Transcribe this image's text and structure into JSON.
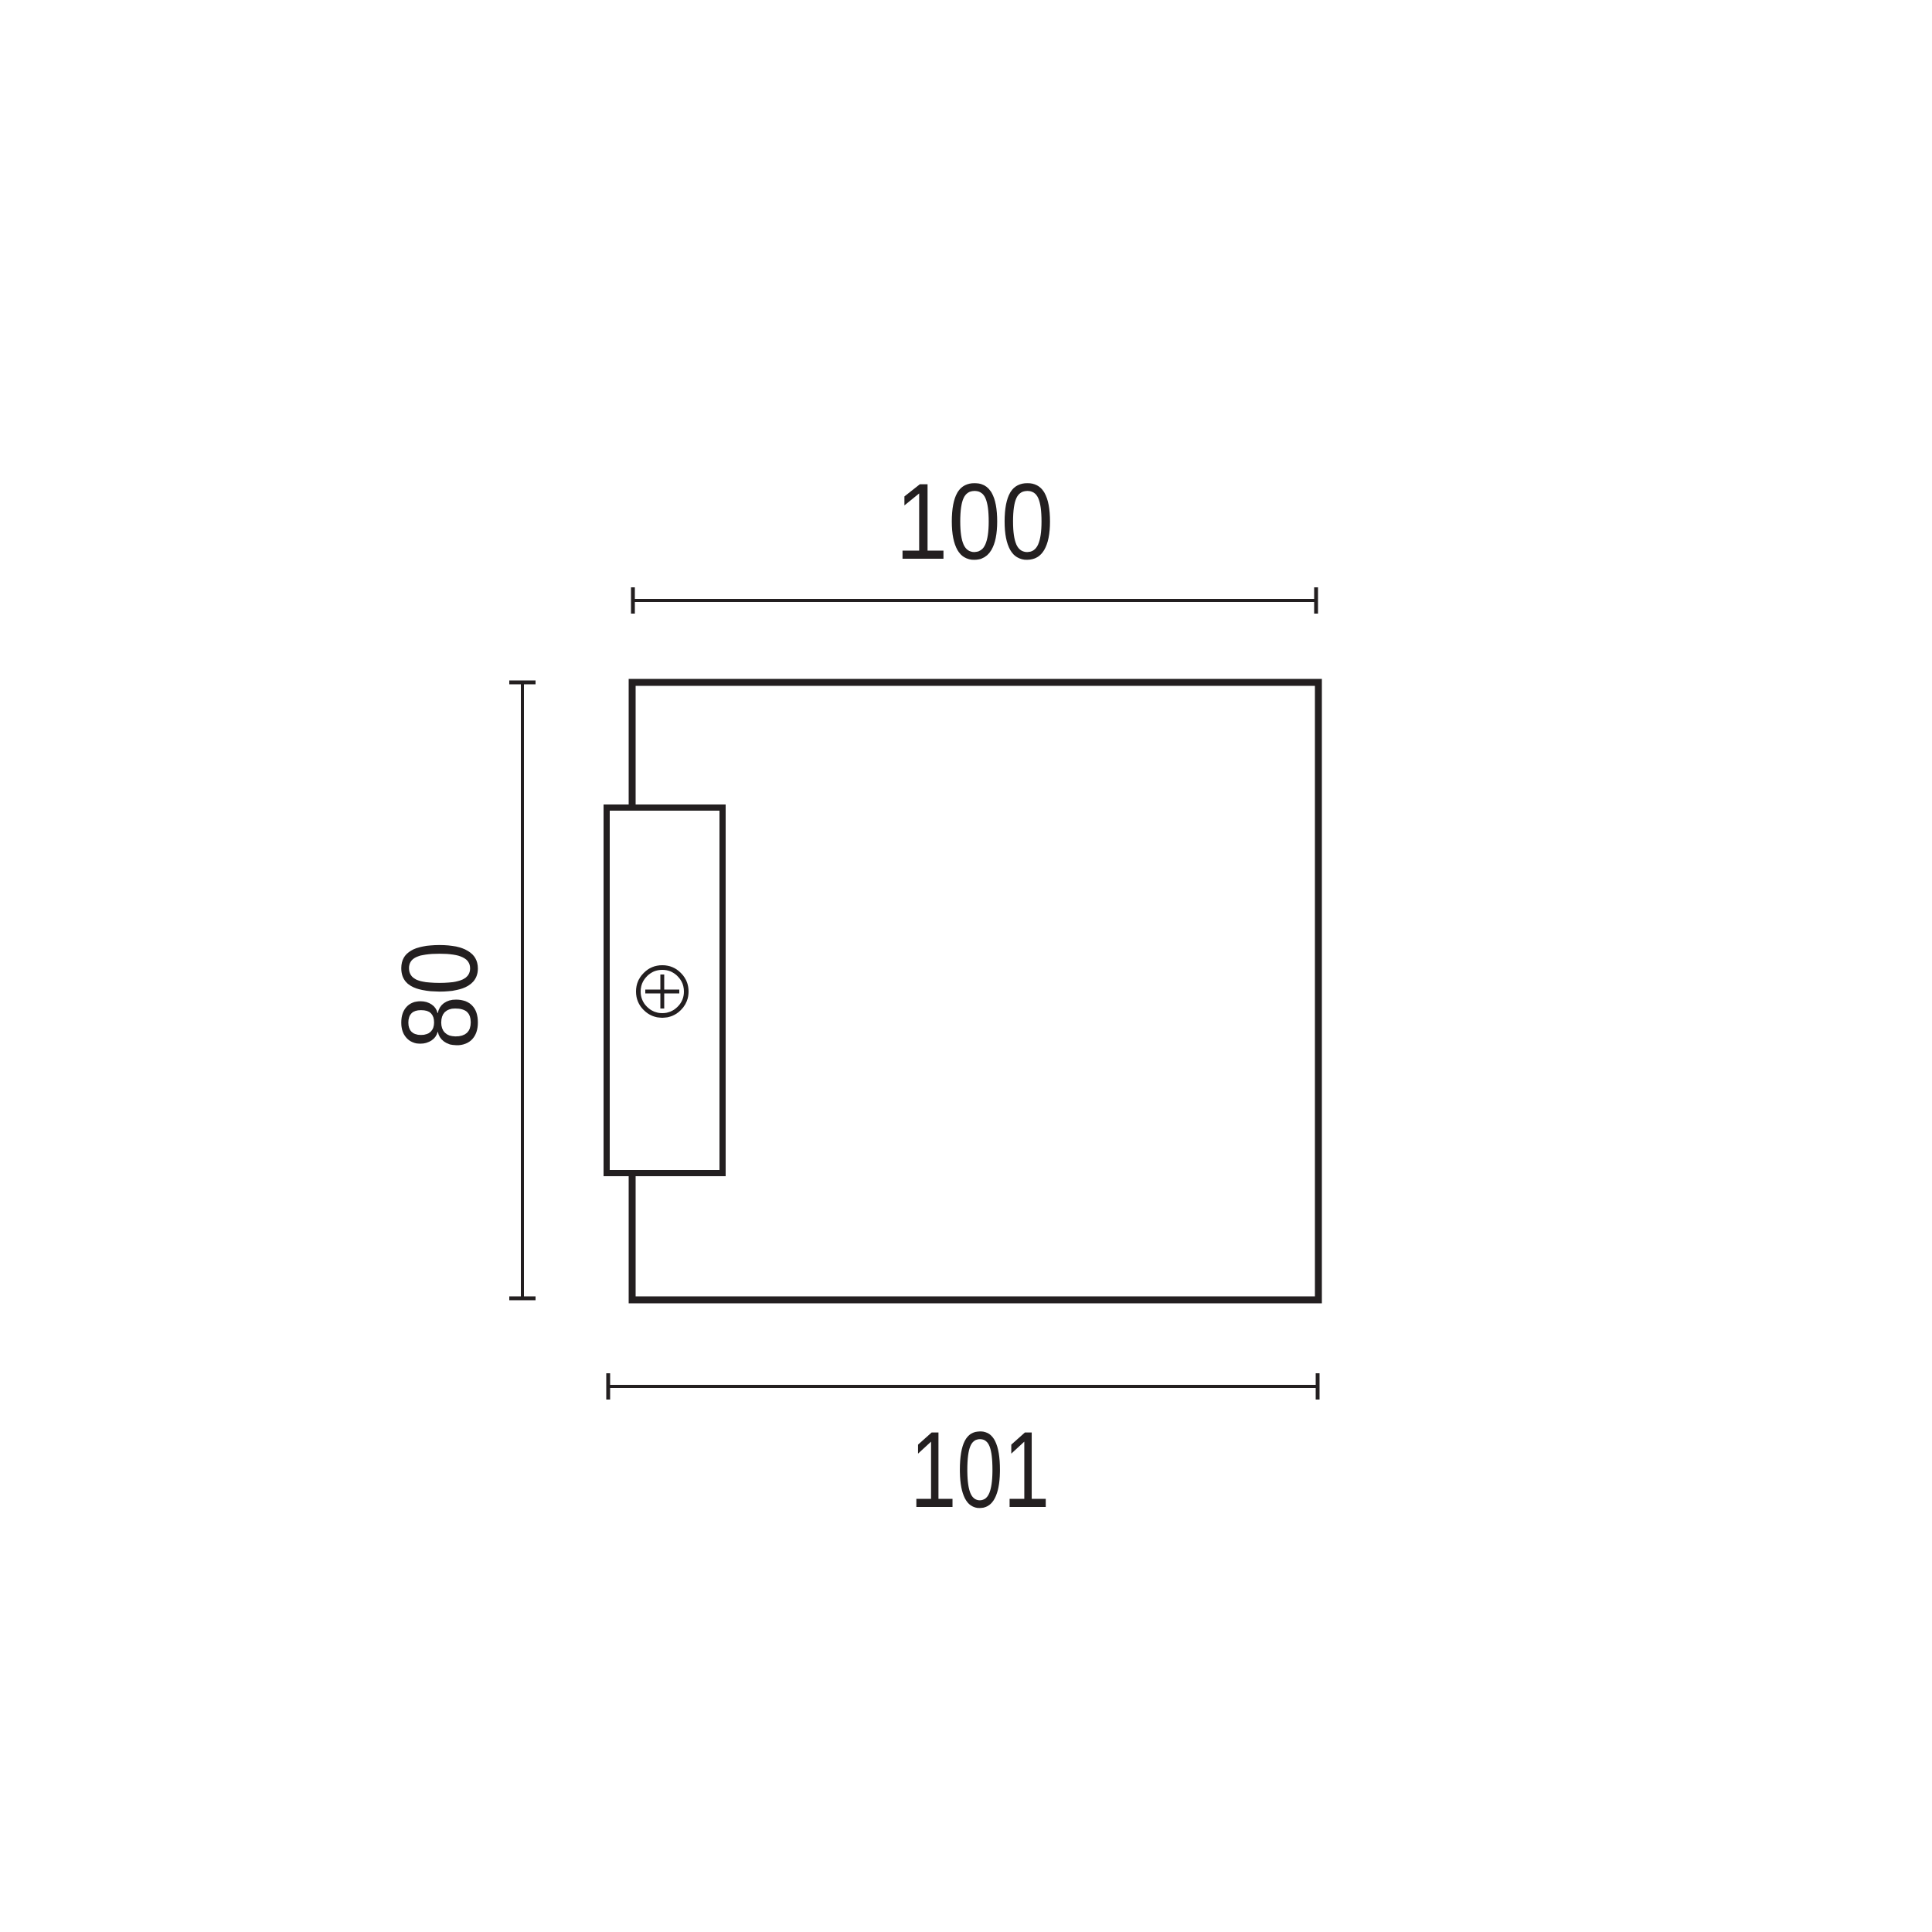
{
  "drawing": {
    "type": "technical-dimension-drawing",
    "stroke_color": "#231f20",
    "background_color": "#ffffff",
    "dimensions": {
      "width_top": "100",
      "height_left": "80",
      "width_bottom": "101"
    },
    "icons": {
      "screw": "crosshead-screw-icon"
    }
  }
}
